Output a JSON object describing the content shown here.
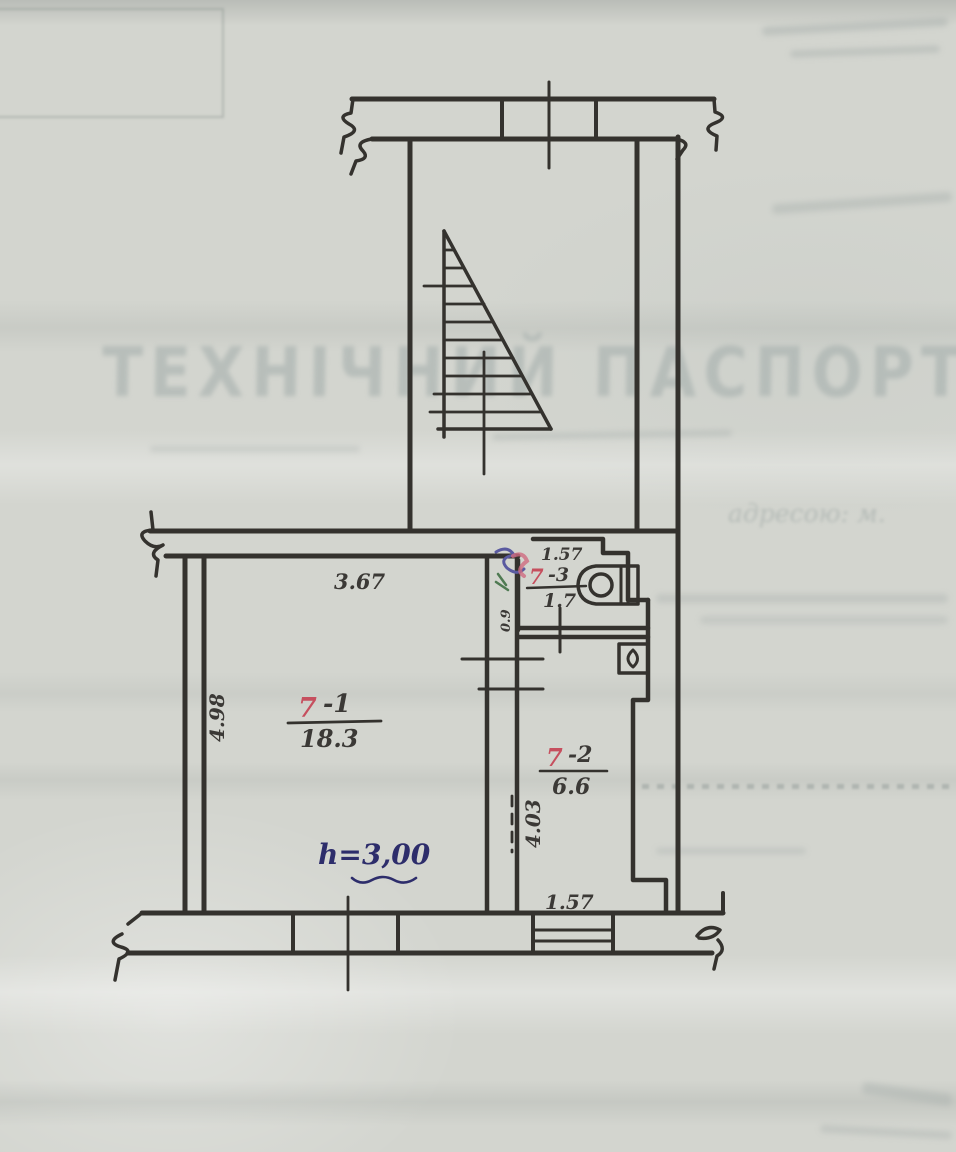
{
  "meta": {
    "description": "Сканований аркуш технічного паспорта з планом поверху"
  },
  "watermark": {
    "title": "ТЕХНІЧНИЙ ПАСПОРТ",
    "address_line": "адресою: м."
  },
  "plan": {
    "rooms": [
      {
        "number": "7",
        "suffix": "-1",
        "area": "18.3"
      },
      {
        "number": "7",
        "suffix": "-2",
        "area": "6.6"
      },
      {
        "number": "7",
        "suffix": "-3",
        "area": "1.7"
      }
    ],
    "dimensions": {
      "room1_width": "3.67",
      "room1_depth": "4.98",
      "room2_depth": "4.03",
      "room3_width": "1.57",
      "room2_width": "1.57",
      "room3_depth": "0.9"
    },
    "height_note": {
      "prefix": "h=",
      "value": "3,00"
    }
  },
  "colors": {
    "paper": "#d3d5cf",
    "ink": "#34322e",
    "room_number_red": "#c64f5e",
    "note_blue": "#2d2d6b",
    "bleed_gray": "#a2acaa"
  }
}
